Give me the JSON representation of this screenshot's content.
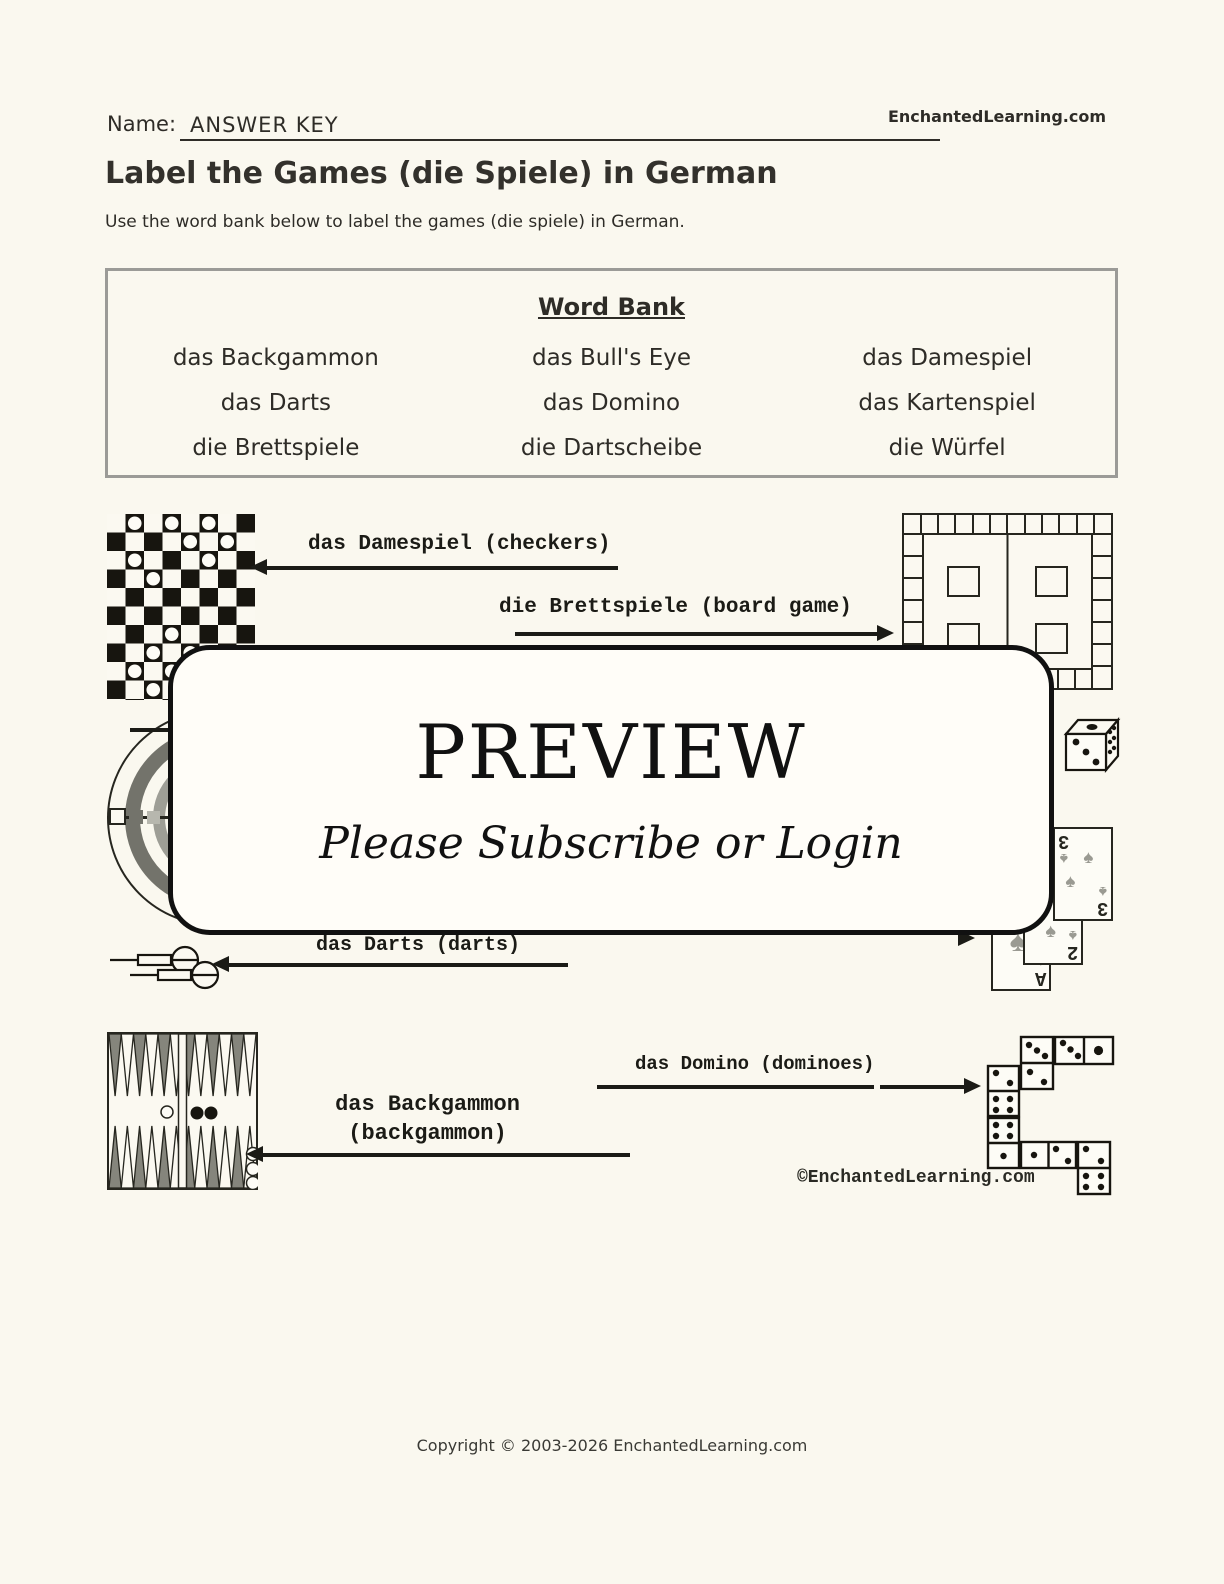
{
  "header": {
    "name_label": "Name:",
    "name_value": "ANSWER KEY",
    "site": "EnchantedLearning.com"
  },
  "title": "Label the Games (die Spiele) in German",
  "instructions": "Use the word bank below to label the games (die spiele) in German.",
  "word_bank": {
    "title": "Word Bank",
    "entries": [
      [
        "das Backgammon",
        "das Bull's Eye",
        "das Damespiel"
      ],
      [
        "das Darts",
        "das Domino",
        "das Kartenspiel"
      ],
      [
        "die Brettspiele",
        "die Dartscheibe",
        "die Würfel"
      ]
    ]
  },
  "answers": {
    "damespiel": "das Damespiel (checkers)",
    "brettspiele": "die Brettspiele (board game)",
    "darts": "das Darts (darts)",
    "backgammon_line1": "das Backgammon",
    "backgammon_line2": "(backgammon)",
    "domino": "das Domino (dominoes)"
  },
  "preview": {
    "title": "PREVIEW",
    "subtitle": "Please Subscribe or Login"
  },
  "cards": {
    "values": [
      "3",
      "2",
      "A"
    ],
    "suit": "♠"
  },
  "watermark": "©EnchantedLearning.com",
  "footer": "Copyright © 2003-2026 EnchantedLearning.com"
}
